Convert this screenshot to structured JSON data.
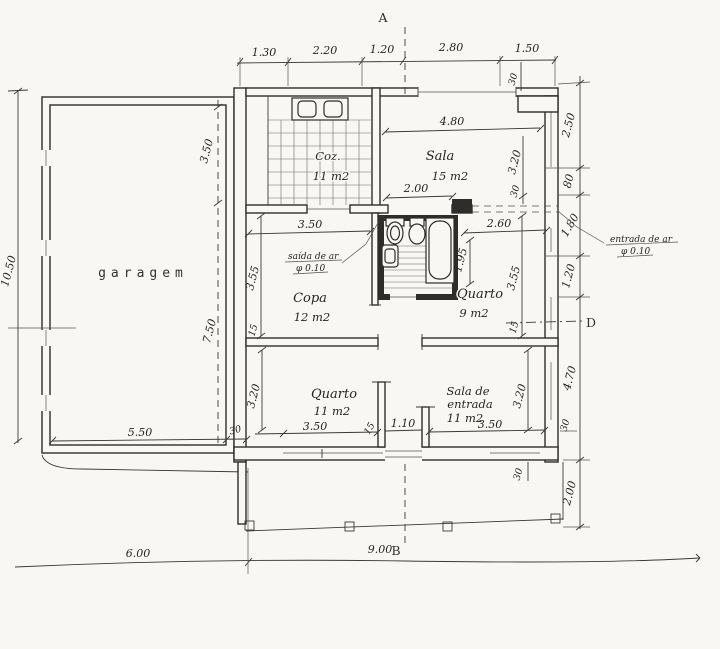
{
  "rooms": {
    "garagem": {
      "label": "garagem"
    },
    "coz": {
      "label": "Coz.",
      "area": "11 m2"
    },
    "sala": {
      "label": "Sala",
      "area": "15 m2"
    },
    "copa": {
      "label": "Copa",
      "area": "12 m2"
    },
    "quarto9": {
      "label": "Quarto",
      "area": "9 m2"
    },
    "quarto11": {
      "label": "Quarto",
      "area": "11 m2"
    },
    "sala_entrada": {
      "label_line1": "Sala de",
      "label_line2": "entrada",
      "area": "11 m2"
    }
  },
  "markers": {
    "a": "A",
    "b": "B",
    "d": "D"
  },
  "annotations": {
    "saida_de_ar": {
      "text": "saída de ar",
      "diameter": "φ 0.10"
    },
    "entrada_de_ar": {
      "text": "entrada de ar",
      "diameter": "φ 0.10"
    }
  },
  "dims": {
    "top": {
      "d1": "1.30",
      "d2": "2.20",
      "d3": "1.20",
      "d4": "2.80",
      "d5": "1.50",
      "wall": "30"
    },
    "right": {
      "d1": "2.50",
      "d2": "80",
      "d3": "1.80",
      "d4": "1.20",
      "d5": "4.70",
      "wall": "30",
      "d6": "2.00"
    },
    "left": {
      "d1": "10.50"
    },
    "garage": {
      "d1": "3.50",
      "d2": "7.50",
      "d3": "5.50",
      "wall": "30"
    },
    "bottom": {
      "d1": "6.00",
      "d2": "9.00"
    },
    "sala": {
      "w": "4.80",
      "door": "2.00",
      "h": "3.20",
      "wall": "30"
    },
    "copa": {
      "w": "3.50",
      "h": "3.55",
      "wall": "15"
    },
    "quarto9": {
      "w": "2.60",
      "bath": "1.95",
      "h": "3.55",
      "wall": "15"
    },
    "quarto11": {
      "h": "3.20",
      "w": "3.50",
      "wall": "15"
    },
    "entrance": {
      "door": "1.10"
    },
    "sala_entrada": {
      "w": "3.50",
      "h": "3.20",
      "wall": "30"
    }
  }
}
